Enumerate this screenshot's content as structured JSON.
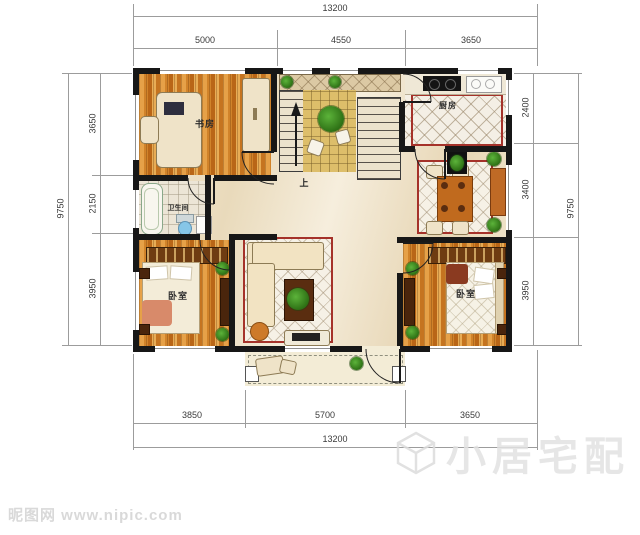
{
  "dimensions": {
    "top": {
      "total": "13200",
      "segments": [
        "5000",
        "4550",
        "3650"
      ]
    },
    "bottom": {
      "total": "13200",
      "segments": [
        "3850",
        "5700",
        "3650"
      ]
    },
    "left": {
      "total": "9750",
      "segments": [
        "3650",
        "2150",
        "3950"
      ]
    },
    "right": {
      "total": "9750",
      "segments": [
        "2400",
        "3400",
        "3950"
      ]
    }
  },
  "rooms": {
    "study": {
      "label": "书房"
    },
    "kitchen": {
      "label": "厨房"
    },
    "bathroom": {
      "label": "卫生间"
    },
    "bedroom_left": {
      "label": "卧室"
    },
    "bedroom_right": {
      "label": "卧室"
    },
    "stairs": {
      "label": "上"
    }
  },
  "watermarks": {
    "site": "昵图网 www.nipic.com",
    "brand": "小居宅配"
  },
  "colors": {
    "wall": "#171717",
    "wood_floor": "#cf7c22",
    "rug_border": "#a5322a",
    "dim_line": "#9c9c9c",
    "tatami": "#ddbe6a",
    "marble": "#f0e4c9"
  }
}
